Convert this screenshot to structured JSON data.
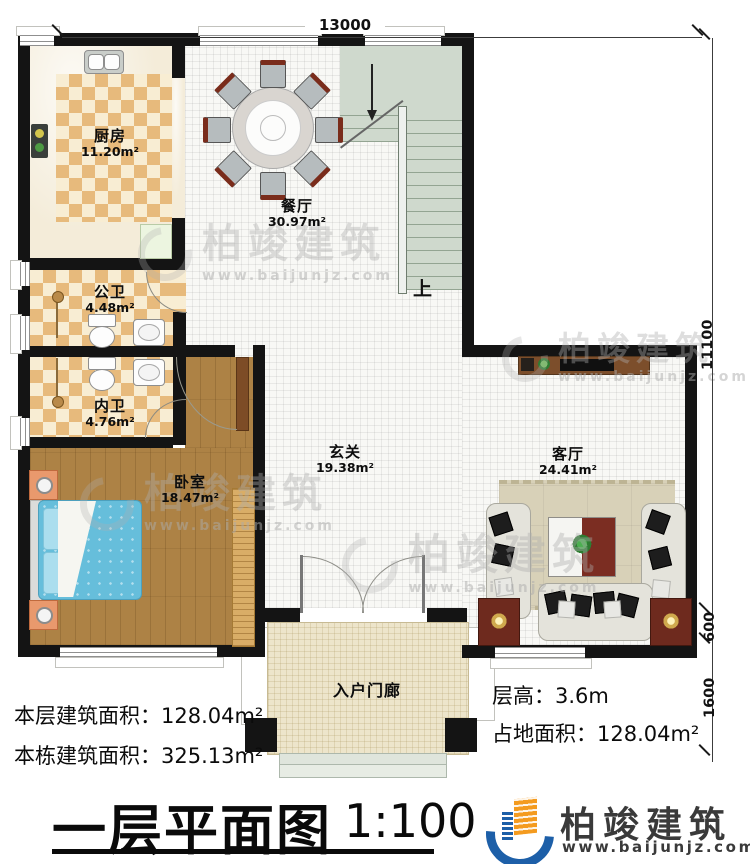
{
  "plan": {
    "type": "first-floor-plan",
    "dims": {
      "top_width": "13000",
      "right_height": "11100",
      "right_mid": "600",
      "right_bottom": "1600"
    },
    "rooms": {
      "kitchen": {
        "name": "厨房",
        "area": "11.20m²"
      },
      "dining": {
        "name": "餐厅",
        "area": "30.97m²"
      },
      "public_bath": {
        "name": "公卫",
        "area": "4.48m²"
      },
      "private_bath": {
        "name": "内卫",
        "area": "4.76m²"
      },
      "bedroom": {
        "name": "卧室",
        "area": "18.47m²"
      },
      "foyer": {
        "name": "玄关",
        "area": "19.38m²"
      },
      "living": {
        "name": "客厅",
        "area": "24.41m²"
      },
      "porch": {
        "name": "入户门廊"
      },
      "stairs": {
        "up_label": "上"
      }
    },
    "info": {
      "floor_area": "本层建筑面积：128.04m²",
      "building_area": "本栋建筑面积：325.13m²",
      "floor_height": "层高：3.6m",
      "land_area": "占地面积：128.04m²"
    },
    "title": {
      "text": "一层平面图",
      "scale": "1:100"
    },
    "logo": {
      "name": "柏竣建筑",
      "url": "www.baijunjz.com"
    },
    "watermark": {
      "name": "柏竣建筑",
      "url": "www.baijunjz.com"
    },
    "colors": {
      "wall": "#141414",
      "wood_floor": "#ad8245",
      "checker_tile_dark": "#e7ba7c",
      "checker_tile_light": "#f8edd3",
      "stair": "#cfd9cd",
      "bed_blue": "#66bedb",
      "table_red": "#7b2d22",
      "logo_blue": "#1d5fa8",
      "logo_orange": "#f49b1f"
    }
  }
}
